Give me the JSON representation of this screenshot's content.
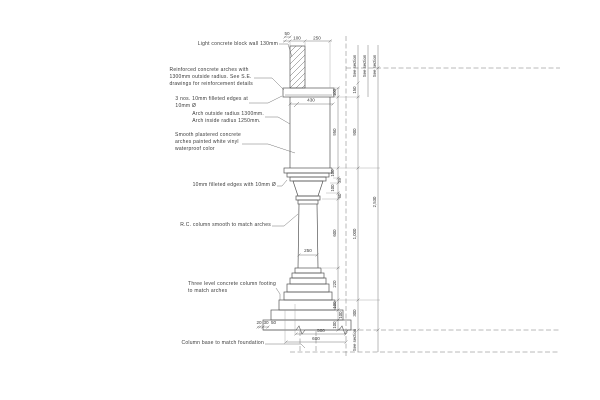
{
  "drawing": {
    "annotations": [
      "Light concrete block wall 130mm",
      "Reinforced concrete arches with\n1300mm outside radius. See S.E.\ndrawings for reinforcement details",
      "3 nos. 10mm filleted edges at\n10mm Ø",
      "Arch outside radius 1300mm.\nArch inside radius 1250mm.",
      "Smooth plastered concrete\narches painted white vinyl\nwaterproof color",
      "10mm filleted edges with 10mm Ø",
      "R.C. column smooth to match arches",
      "Three level concrete column footing\nto match arches",
      "Column base to match foundation"
    ],
    "dims": {
      "top_offset": "50",
      "top": [
        "100",
        "250"
      ],
      "arch_width": "430",
      "shaft_width": "250",
      "bottom_offsets": [
        "20",
        "30",
        "50"
      ],
      "base_width": "500",
      "footing_width": "600",
      "right_inner": [
        "100",
        "950",
        "100",
        "35",
        "100",
        "60",
        "600",
        "220",
        "100",
        "100",
        "100"
      ],
      "right_middle": [
        "150",
        "900",
        "1,000",
        "300"
      ],
      "overall_height": "2,530",
      "see_section": "See section"
    },
    "colors": {
      "line": "#555555",
      "text": "#3a3a3a",
      "background": "#ffffff"
    }
  }
}
